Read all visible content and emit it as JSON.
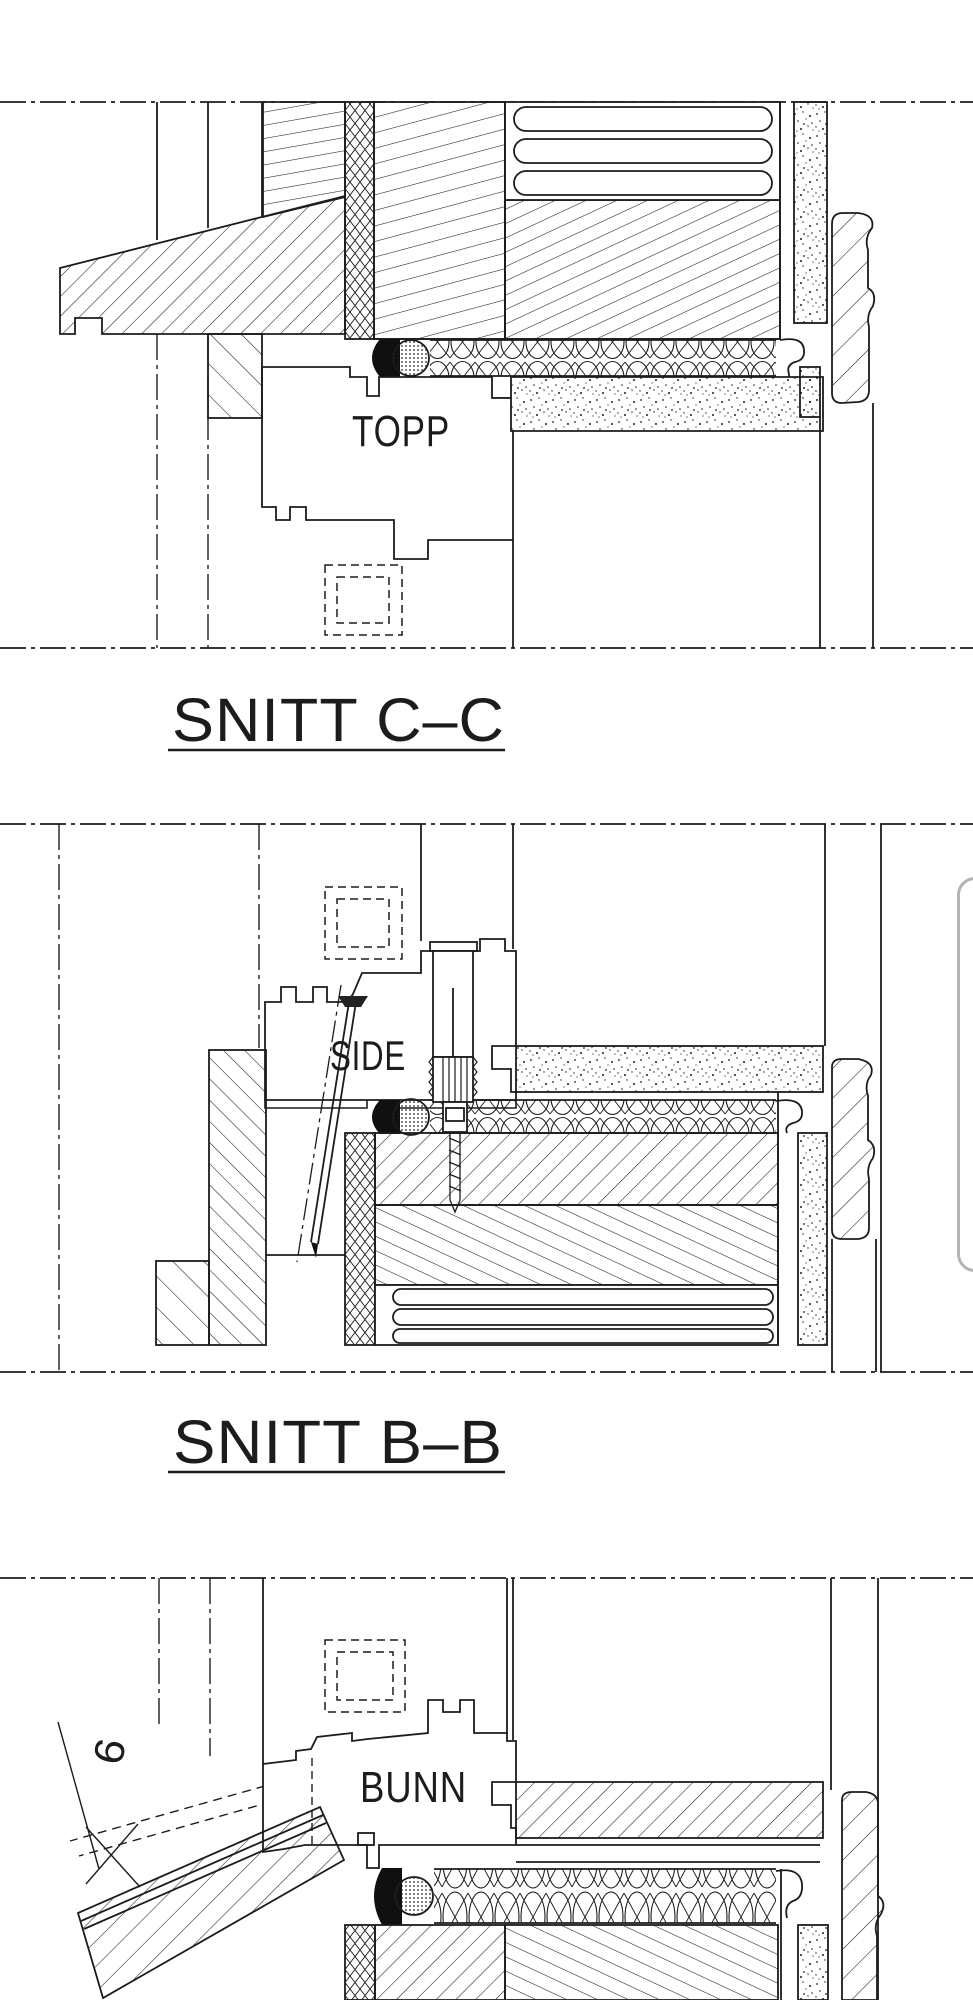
{
  "document": {
    "kind": "technical section drawing",
    "sections": [
      {
        "label": "TOPP",
        "title": "SNITT C–C"
      },
      {
        "label": "SIDE",
        "title": "SNITT B–B"
      },
      {
        "label": "BUNN",
        "annotation": "6"
      }
    ]
  },
  "colors": {
    "background": "#ffffff",
    "line": "#1c1c1c",
    "seal_fill": "#101010",
    "scrollbar_border": "#b4b4b4"
  }
}
